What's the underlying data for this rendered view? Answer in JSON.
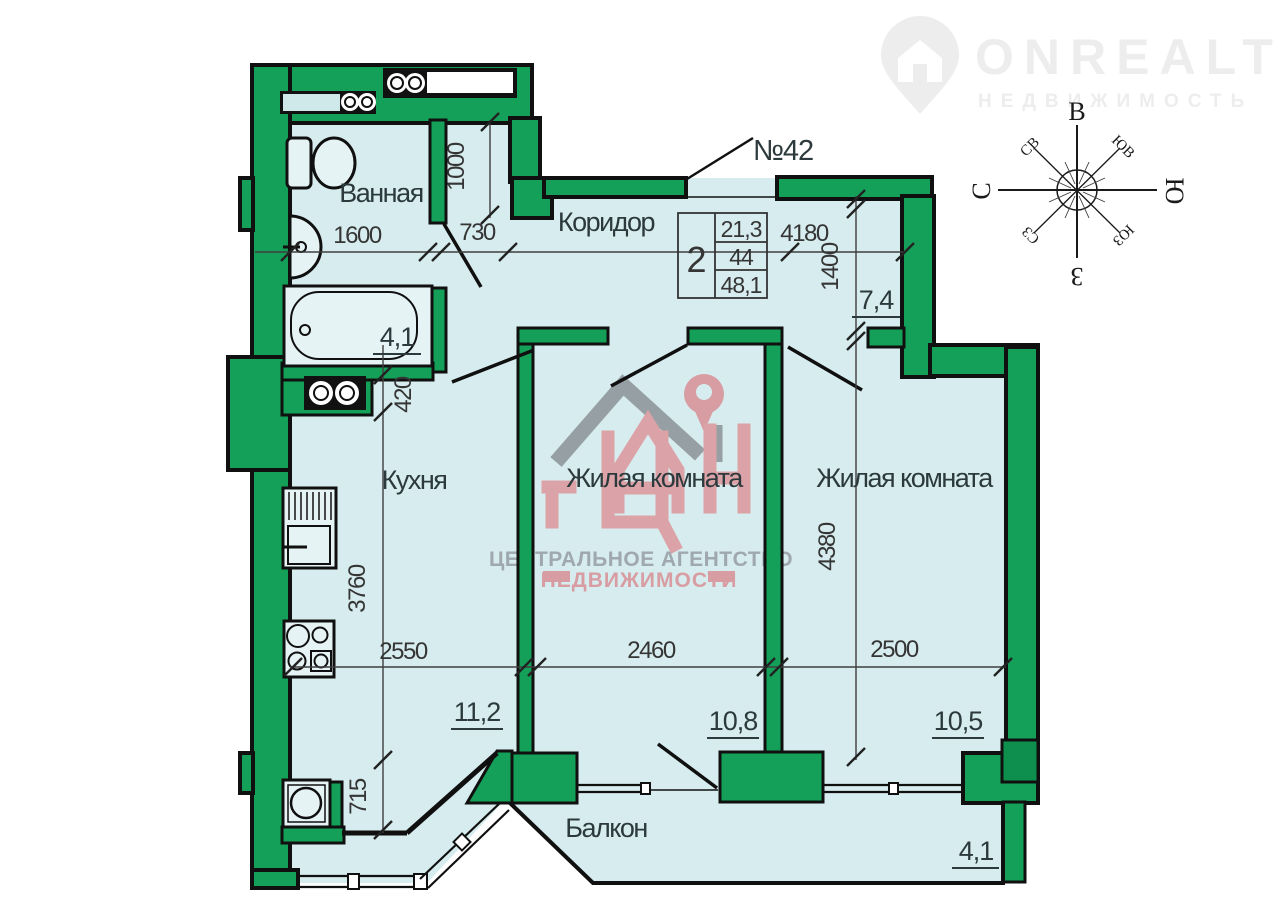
{
  "brand": {
    "name": "ONREALT",
    "tagline": "НЕДВИЖИМОСТЬ"
  },
  "agency": {
    "line1": "ЦЕНТРАЛЬНОЕ АГЕНТСТВО",
    "line2": "НЕДВИЖИМОСТИ"
  },
  "unit": {
    "number": "№42",
    "table": {
      "rooms": "2",
      "row1": "21,3",
      "row2": "44",
      "row3": "48,1"
    }
  },
  "rooms": [
    {
      "name": "Ванная",
      "area": "4,1"
    },
    {
      "name": "Коридор",
      "area": "7,4"
    },
    {
      "name": "Кухня",
      "area": "11,2"
    },
    {
      "name": "Жилая комната",
      "area": "10,8"
    },
    {
      "name": "Жилая комната",
      "area": "10,5"
    },
    {
      "name": "Балкон",
      "area": "4,1"
    }
  ],
  "dimensions": {
    "bath_w": "1600",
    "bath_door": "730",
    "nook": "1000",
    "hall": "4180",
    "hall_d": "1400",
    "kitchen_off": "420",
    "kitchen_h": "3760",
    "kitchen_w": "2550",
    "room1_w": "2460",
    "room2_w": "2500",
    "room2_h": "4380",
    "kitchen_b": "715"
  },
  "compass": {
    "top": "В",
    "left": "С",
    "right": "Ю",
    "bottom": "З",
    "top_left": "СВ",
    "top_right": "ЮВ",
    "bottom_left": "СЗ",
    "bottom_right": "ЮЗ"
  },
  "colors": {
    "wall": "#14a058",
    "fill": "#d7ecee",
    "pink": "#d8959b",
    "gray": "#929aa0"
  }
}
